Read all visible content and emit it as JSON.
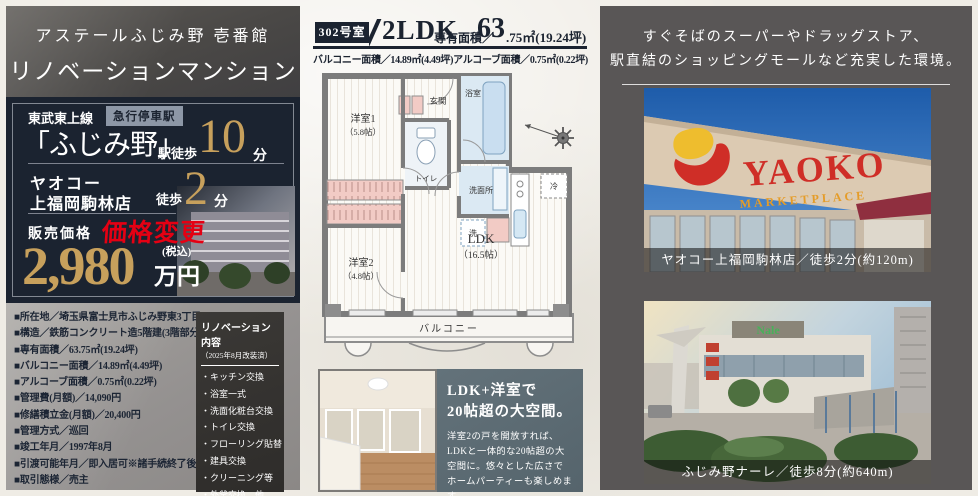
{
  "left_panel": {
    "title_line1": "アステールふじみ野 壱番館",
    "title_line2": "リノベーションマンション",
    "access": {
      "line_name": "東武東上線",
      "badge": "急行停車駅",
      "station": "「ふじみ野」",
      "walk_label": "駅徒歩",
      "minutes": "10",
      "minutes_unit": "分"
    },
    "store": {
      "name_line1": "ヤオコー",
      "name_line2": "上福岡駒林店",
      "walk_label": "徒歩",
      "minutes": "2",
      "minutes_unit": "分"
    },
    "price": {
      "label": "販売価格",
      "change_note": "価格変更",
      "amount": "2,980",
      "tax_note": "(税込)",
      "unit": "万円"
    },
    "specs": [
      "■所在地／埼玉県富士見市ふじみ野東3丁目18-3",
      "■構造／鉄筋コンクリート造5階建(3階部分)",
      "■専有面積／63.75㎡(19.24坪)",
      "■バルコニー面積／14.89㎡(4.49坪)",
      "■アルコーブ面積／0.75㎡(0.22坪)",
      "■管理費(月額)／14,090円",
      "■修繕積立金(月額)／20,400円",
      "■管理方式／巡回",
      "■竣工年月／1997年8月",
      "■引渡可能年月／即入居可※諸手続終了後",
      "■取引態様／売主"
    ]
  },
  "plan_header": {
    "unit_no": "302号室",
    "layout": "2LDK",
    "area_label": "専有面積／",
    "area_big": "63",
    "area_small": ".75㎡(19.24坪)",
    "subline": "バルコニー面積／14.89㎡(4.49坪)アルコーブ面積／0.75㎡(0.22坪)"
  },
  "floor_plan": {
    "room1": "洋室1",
    "room1_size": "（5.8帖）",
    "room2": "洋室2",
    "room2_size": "（4.8帖）",
    "ldk": "LDK",
    "ldk_size": "（16.5帖）",
    "entrance": "玄関",
    "bath": "浴室",
    "toilet": "トイレ",
    "washroom": "洗面所",
    "laundry": "洗",
    "fridge": "冷",
    "balcony": "バルコニー"
  },
  "renovation": {
    "title": "リノベーション内容",
    "subtitle": "（2025年8月改装済）",
    "items": [
      "・キッチン交換",
      "・浴室一式",
      "・洗面化粧台交換",
      "・トイレ交換",
      "・フローリング貼替",
      "・建具交換",
      "・クリーニング等",
      "・外釜交換、他"
    ]
  },
  "feature": {
    "title_line1": "LDK+洋室で",
    "title_line2": "20帖超の大空間。",
    "body": "洋室2の戸を開放すれば、LDKと一体的な20帖超の大空間に。悠々とした広さでホームパーティーも楽しめます。"
  },
  "right_panel": {
    "heading_line1": "すぐそばのスーパーやドラッグストア、",
    "heading_line2": "駅直結のショッピングモールなど充実した環境。",
    "photo1": {
      "caption": "ヤオコー上福岡駒林店／徒歩2分(約120m)",
      "logo": "YAOKO",
      "logo_sub": "MARKETPLACE"
    },
    "photo2": {
      "caption": "ふじみ野ナーレ／徒歩8分(約640m)",
      "sign": "Nale"
    }
  },
  "colors": {
    "navy": "#1b2330",
    "gold": "#c7a05c",
    "price_change_red": "#e50013",
    "slate": "#5b6a72",
    "right_bg": "#595656"
  }
}
